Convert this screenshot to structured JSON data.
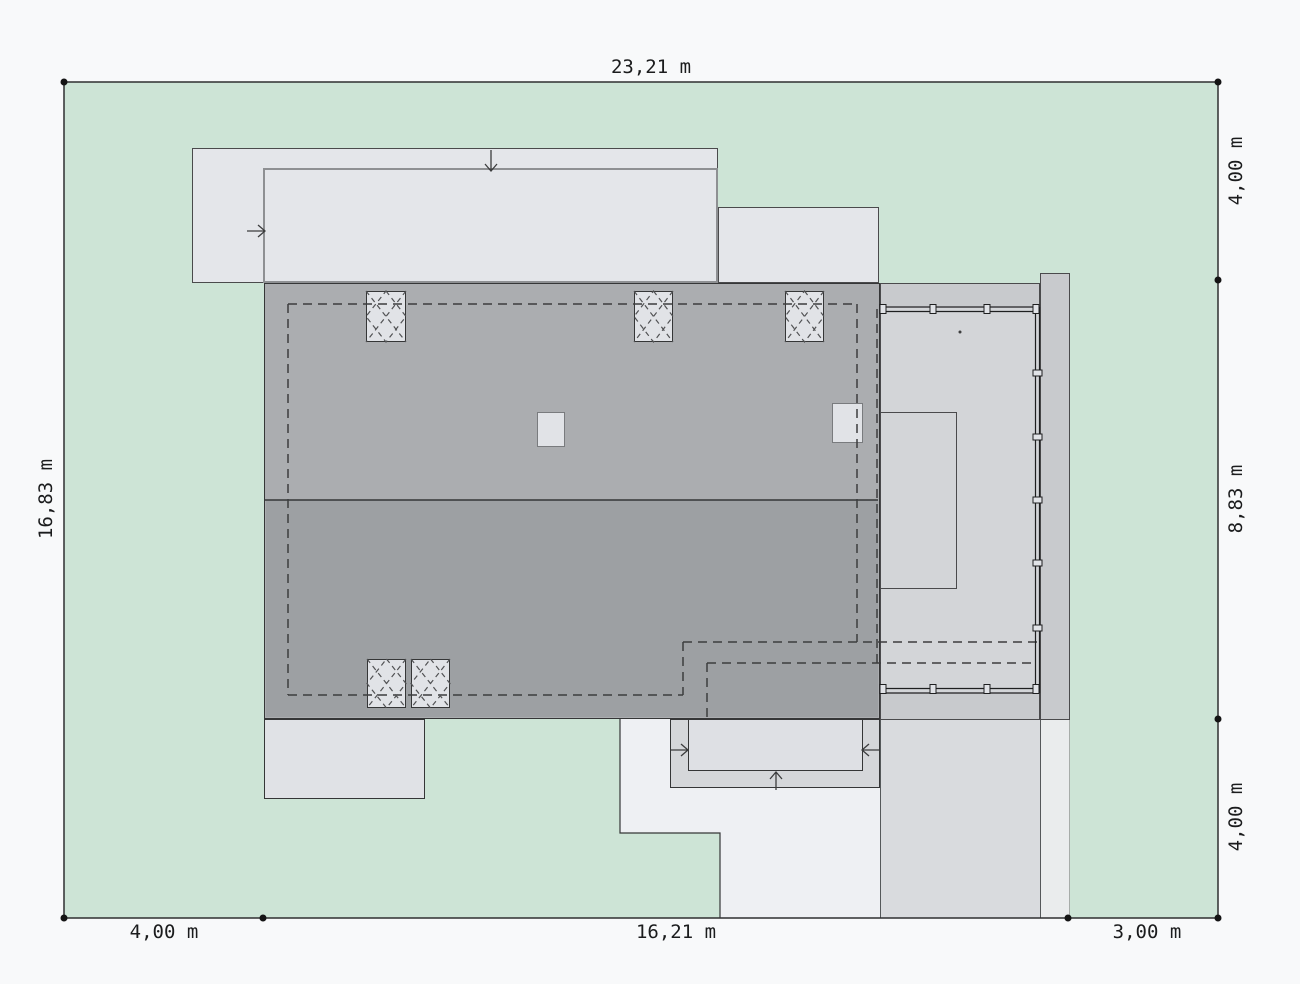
{
  "title": "House site plan with plot dimensions",
  "dimensions": {
    "top": "23,21 m",
    "left": "16,83 m",
    "right_top": "4,00 m",
    "right_middle": "8,83 m",
    "right_bottom": "4,00 m",
    "bottom_left": "4,00 m",
    "bottom_middle": "16,21 m",
    "bottom_right": "3,00 m"
  },
  "colors": {
    "paper": "#f8f9fa",
    "grass": "#cde4d6",
    "eave": "#e4e6ea",
    "eave_border": "#4a4a4c",
    "inner_border": "#8e9093",
    "roof_upper": "#abadb0",
    "roof_lower": "#9da0a3",
    "roof_border": "#353637",
    "terrace_frame": "#c8cacd",
    "terrace_deck": "#d3d5d8",
    "chimney": "#e1e3e7",
    "block_border": "#797b7e",
    "porch_left": "#e0e2e6",
    "porch_mid_outer": "#d5d7da",
    "porch_mid_inner": "#dee0e4",
    "path": "#eef0f3",
    "driveway": "#d9dbde",
    "drive_border": "#55585a",
    "strip": "#eaeced",
    "strip_border": "#a7aca9",
    "line": "#2e2f30",
    "dash": "#3c3d3e",
    "dash2": "#515254",
    "rail": "#1e1f20",
    "text": "#1b1c1d",
    "dot": "#141414"
  }
}
